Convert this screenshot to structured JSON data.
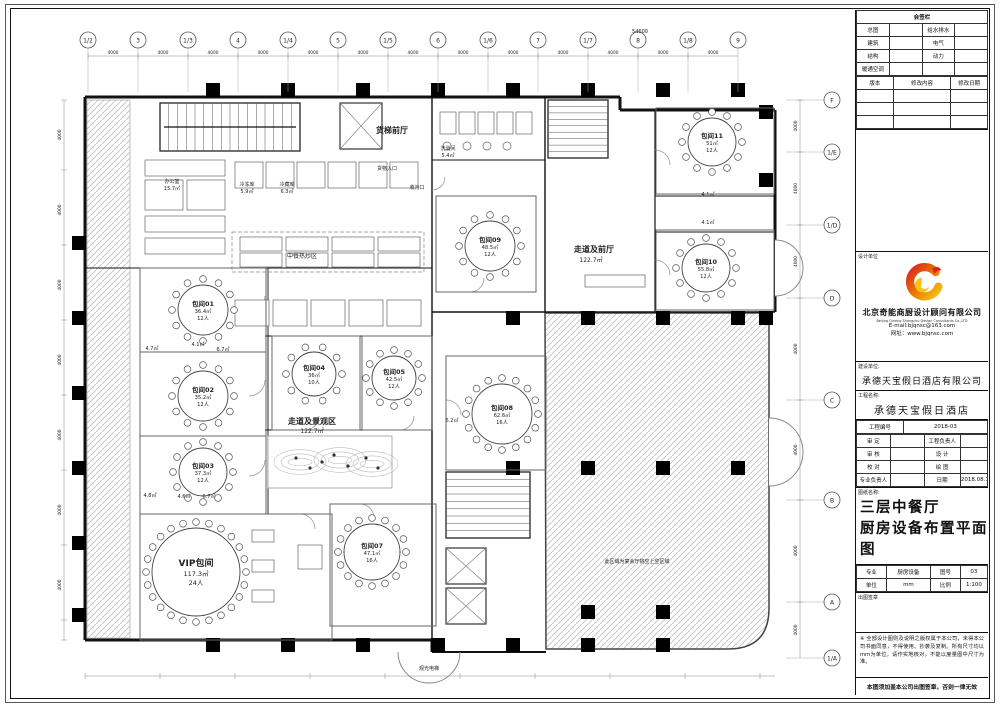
{
  "titleblock": {
    "sign_table": {
      "title": "会签栏",
      "rows": [
        [
          "总图",
          "给水排水"
        ],
        [
          "建筑",
          "电气"
        ],
        [
          "结构",
          "动力"
        ],
        [
          "暖通空调",
          ""
        ]
      ],
      "rev_header": [
        "版本",
        "修改内容",
        "修改日期"
      ]
    },
    "design_unit_label": "设计单位",
    "company_cn": "北京奇能商厨设计顾问有限公司",
    "company_en": "Beijing Qineng Shangchu Design Consultants Co.,LTD",
    "email": "E-mail:bjqnsc@163.com",
    "website": "网址：www.bjqnsc.com",
    "client_label": "建设单位:",
    "client": "承德天宝假日酒店有限公司",
    "project_label": "工程名称:",
    "project": "承德天宝假日酒店",
    "project_no_label": "工程编号",
    "project_no": "2018-03",
    "approval_rows": [
      [
        "审 定",
        "工程负责人"
      ],
      [
        "审 核",
        "设 计"
      ],
      [
        "校 对",
        "绘 图"
      ]
    ],
    "lead_label": "专业负责人",
    "date_label": "日期",
    "date": "2018.08.12",
    "drawing_name_label": "图纸名称:",
    "drawing_title_1": "三层中餐厅",
    "drawing_title_2": "厨房设备布置平面图",
    "spec_label": "专业",
    "spec": "厨房设备",
    "no_label": "图号",
    "no": "03",
    "unit_label": "单位",
    "unit": "mm",
    "scale_label": "比例",
    "scale": "1:100",
    "seal_label": "出图签章",
    "note": "※ 全部设计图则及说明之版权属于本公司，未得本公司书面同意，不得使用、抄袭及复制。所有尺寸均以mm为单位，请作实地核对，不能以度量图中尺寸为准。",
    "footer": "本图须加盖本公司出图签章，否则一律无效",
    "logo_colors": {
      "red": "#d9251c",
      "orange": "#f08300",
      "yellow": "#f6c514"
    }
  },
  "grid": {
    "top_labels": [
      "1/2",
      "3",
      "1/3",
      "4",
      "1/4",
      "5",
      "1/5",
      "6",
      "1/6",
      "7",
      "1/7",
      "8",
      "1/8",
      "9"
    ],
    "top_dim": "4000",
    "top_total": "54600",
    "right_labels": [
      {
        "label": "F",
        "y": 100
      },
      {
        "label": "1/E",
        "y": 152
      },
      {
        "label": "1/D",
        "y": 225
      },
      {
        "label": "D",
        "y": 298
      },
      {
        "label": "C",
        "y": 400
      },
      {
        "label": "B",
        "y": 500
      },
      {
        "label": "A",
        "y": 602
      },
      {
        "label": "1/A",
        "y": 658
      }
    ],
    "side_dim": "4000"
  },
  "plan": {
    "rooms": [
      {
        "name": "包间01",
        "area": "36.4㎡",
        "cap": "12人",
        "rect": [
          140,
          268,
          126,
          84
        ],
        "table": {
          "cx": 203,
          "cy": 310,
          "r": 25,
          "seats": 12
        }
      },
      {
        "name": "包间02",
        "area": "35.2㎡",
        "cap": "12人",
        "rect": [
          140,
          352,
          126,
          84
        ],
        "table": {
          "cx": 203,
          "cy": 396,
          "r": 25,
          "seats": 12
        }
      },
      {
        "name": "包间03",
        "area": "37.3㎡",
        "cap": "12人",
        "rect": [
          140,
          436,
          126,
          78
        ],
        "table": {
          "cx": 203,
          "cy": 472,
          "r": 24,
          "seats": 12
        }
      },
      {
        "name": "VIP包间",
        "area": "117.3㎡",
        "cap": "24人",
        "rect": [
          140,
          514,
          192,
          126
        ],
        "table": {
          "cx": 196,
          "cy": 572,
          "r": 44,
          "seats": 24
        },
        "big": true
      },
      {
        "name": "包间04",
        "area": "36㎡",
        "cap": "10人",
        "rect": [
          272,
          336,
          88,
          94
        ],
        "table": {
          "cx": 314,
          "cy": 374,
          "r": 22,
          "seats": 10
        }
      },
      {
        "name": "包间05",
        "area": "42.5㎡",
        "cap": "12人",
        "rect": [
          362,
          336,
          70,
          94
        ],
        "table": {
          "cx": 394,
          "cy": 378,
          "r": 22,
          "seats": 12
        }
      },
      {
        "name": "包间07",
        "area": "47.1㎡",
        "cap": "16人",
        "rect": [
          330,
          504,
          106,
          122
        ],
        "table": {
          "cx": 372,
          "cy": 552,
          "r": 28,
          "seats": 16
        }
      },
      {
        "name": "包间08",
        "area": "62.6㎡",
        "cap": "16人",
        "rect": [
          446,
          356,
          100,
          114
        ],
        "table": {
          "cx": 502,
          "cy": 414,
          "r": 30,
          "seats": 16
        }
      },
      {
        "name": "包间09",
        "area": "48.5㎡",
        "cap": "12人",
        "rect": [
          436,
          196,
          100,
          96
        ],
        "table": {
          "cx": 490,
          "cy": 246,
          "r": 25,
          "seats": 12
        }
      },
      {
        "name": "包间10",
        "area": "55.8㎡",
        "cap": "12人",
        "rect": [
          656,
          230,
          118,
          80
        ],
        "table": {
          "cx": 706,
          "cy": 268,
          "r": 24,
          "seats": 12
        }
      },
      {
        "name": "包间11",
        "area": "51㎡",
        "cap": "12人",
        "rect": [
          656,
          108,
          118,
          86
        ],
        "table": {
          "cx": 712,
          "cy": 142,
          "r": 24,
          "seats": 12
        }
      }
    ],
    "annotations": [
      {
        "text": "货梯前厅",
        "x": 392,
        "y": 133,
        "size": 8,
        "bold": true
      },
      {
        "text": "货物入口",
        "x": 387,
        "y": 170,
        "size": 5
      },
      {
        "text": "收污口",
        "x": 417,
        "y": 189,
        "size": 5
      },
      {
        "text": "洗消间",
        "x": 448,
        "y": 150,
        "size": 5
      },
      {
        "text": "5.4㎡",
        "x": 448,
        "y": 157,
        "size": 5
      },
      {
        "text": "办公室",
        "x": 172,
        "y": 183,
        "size": 5
      },
      {
        "text": "15.7㎡",
        "x": 172,
        "y": 190,
        "size": 5
      },
      {
        "text": "冷冻库",
        "x": 247,
        "y": 186,
        "size": 5
      },
      {
        "text": "5.9㎡",
        "x": 247,
        "y": 193,
        "size": 5
      },
      {
        "text": "冷藏库",
        "x": 287,
        "y": 186,
        "size": 5
      },
      {
        "text": "6.3㎡",
        "x": 287,
        "y": 193,
        "size": 5
      },
      {
        "text": "中餐热炒区",
        "x": 302,
        "y": 258,
        "size": 6
      },
      {
        "text": "走道及景观区",
        "x": 312,
        "y": 424,
        "size": 8,
        "bold": true
      },
      {
        "text": "122.7㎡",
        "x": 312,
        "y": 433,
        "size": 6
      },
      {
        "text": "走道及前厅",
        "x": 594,
        "y": 252,
        "size": 8,
        "bold": true
      },
      {
        "text": "122.7㎡",
        "x": 591,
        "y": 262,
        "size": 6
      },
      {
        "text": "观光电梯",
        "x": 429,
        "y": 670,
        "size": 5
      },
      {
        "text": "此区域为宴会厅挑空上空区域",
        "x": 637,
        "y": 563,
        "size": 5
      },
      {
        "text": "4.7㎡",
        "x": 152,
        "y": 350,
        "size": 5
      },
      {
        "text": "4.1㎡",
        "x": 198,
        "y": 346,
        "size": 5
      },
      {
        "text": "6.7㎡",
        "x": 223,
        "y": 351,
        "size": 5
      },
      {
        "text": "4.8㎡",
        "x": 150,
        "y": 497,
        "size": 5
      },
      {
        "text": "4.6㎡",
        "x": 184,
        "y": 498,
        "size": 5
      },
      {
        "text": "6.7㎡",
        "x": 209,
        "y": 498,
        "size": 5
      },
      {
        "text": "6.2㎡",
        "x": 452,
        "y": 422,
        "size": 5
      },
      {
        "text": "4.1㎡",
        "x": 708,
        "y": 196,
        "size": 5
      },
      {
        "text": "4.1㎡",
        "x": 708,
        "y": 224,
        "size": 5
      }
    ]
  }
}
